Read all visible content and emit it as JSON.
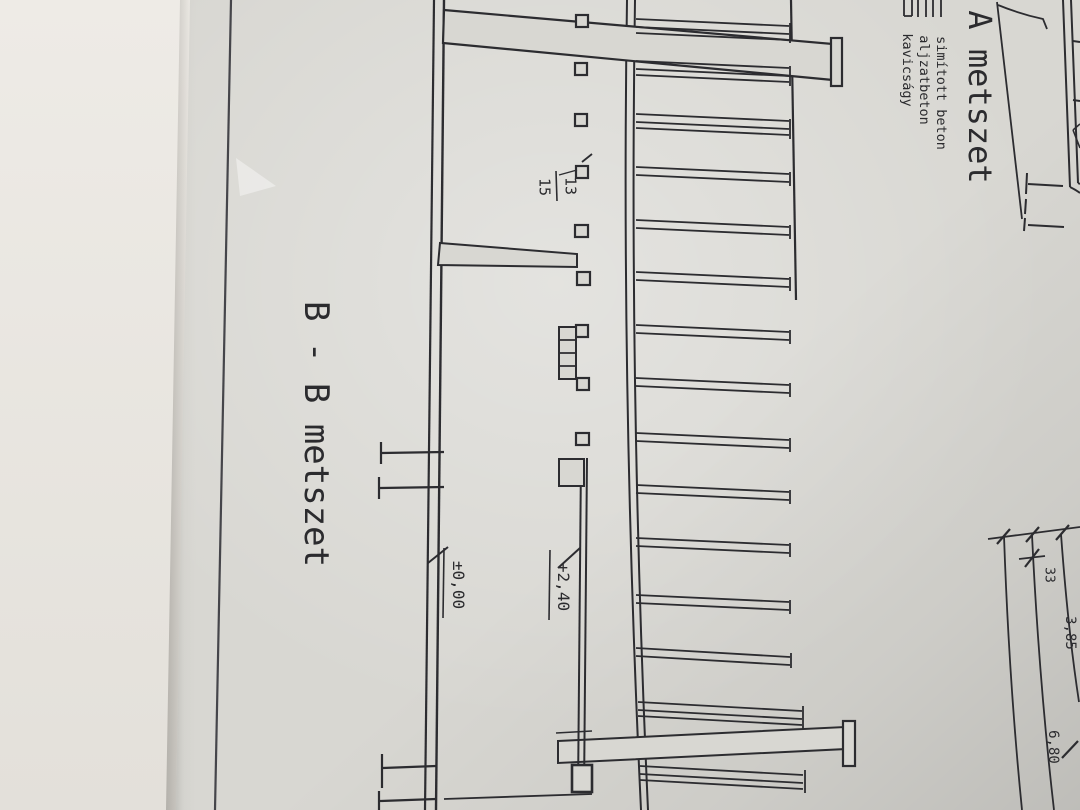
{
  "photo": {
    "surface_color": "#ebe8e2",
    "paper_color": "#d8d7d2",
    "ink_color": "#2c2c30"
  },
  "titles": {
    "section_b": "B - B metszet",
    "section_a": "A metszet"
  },
  "legend": {
    "items": [
      "simított beton",
      "aljzatbeton",
      "kavicságy"
    ]
  },
  "levels": {
    "floor": "±0,00",
    "upper": "+2,40"
  },
  "purlin_label": {
    "top": "13",
    "bottom": "15"
  },
  "dims": {
    "small": "33",
    "mid": "3,85",
    "large": "6,80"
  }
}
